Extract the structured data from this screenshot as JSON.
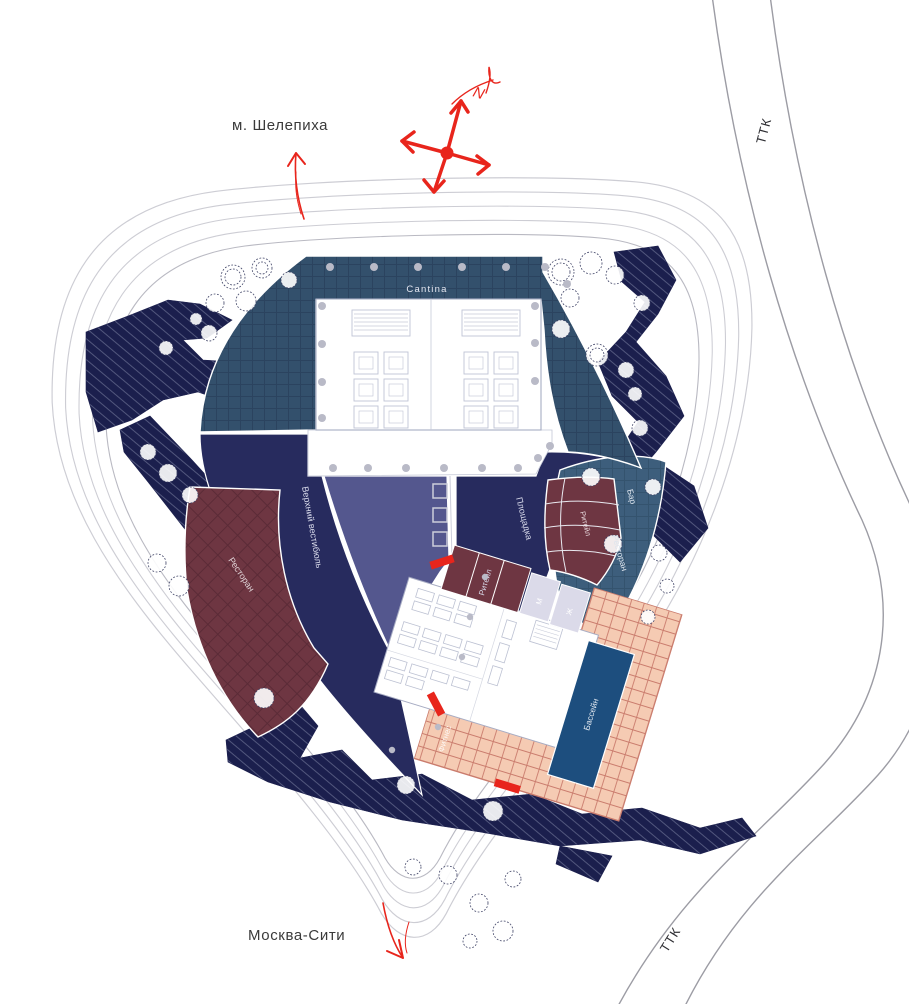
{
  "map": {
    "labels": {
      "metro": "м. Шелепиха",
      "city": "Москва-Сити",
      "road_top": "ТТК",
      "road_bottom": "ТТК",
      "north": "N"
    },
    "zones": {
      "cantina": "Cantina",
      "upper_vestibule": "Верхний вестибюль",
      "ploshchadka": "Площадка",
      "restaurant_left": "Ресторан",
      "retail_upper": "Ритейл",
      "bar": "Бар",
      "restaurant_right": "Ресторан",
      "retail_lower": "Ритейл",
      "wc_men": "М",
      "wc_women": "Ж",
      "pool": "Бассейн",
      "fitness": "Фитнес"
    },
    "colors": {
      "accent_red": "#e8251c",
      "landform_navy": "#1b1f4d",
      "plaza_navy": "#272b5e",
      "slate_purple": "#54578e",
      "cantina_steelblue": "#33506c",
      "arc_steelblue": "#3d5e7c",
      "maroon": "#6e3642",
      "pool_blue": "#1d4e7e",
      "deck_pink": "#f5cbb3",
      "wc_lavender": "#dbdae9"
    }
  }
}
